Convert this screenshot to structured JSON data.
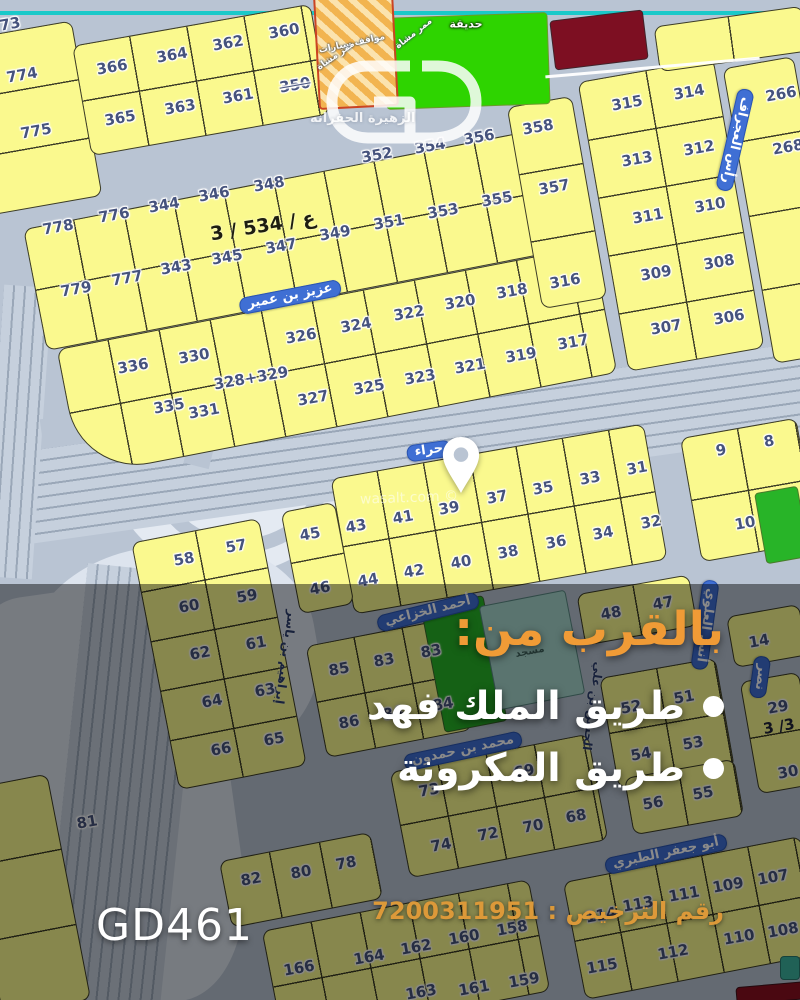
{
  "colors": {
    "plot_yellow": "#FAF98E",
    "plot_line": "#3C3C26",
    "road": "#B9C4D3",
    "road_light": "#C6D0DD",
    "road_dark": "#9AA7B8",
    "cyan_line": "#1AC9C9",
    "badge_blue": "#3F6FD4",
    "park_green": "#2ED400",
    "park_green2": "#28B428",
    "teal_plot": "#A7D6CD",
    "teal_icon": "#3BB3A0",
    "maroon": "#7D0F22",
    "red_bar": "#8A1020",
    "hatch_orange": "#F2B450",
    "hatch_light": "#FBE3AE",
    "hatch_border": "#CC4422",
    "number_blue": "#46537D",
    "promo_orange": "#F09B36",
    "license_orange": "#DC9939"
  },
  "overlay": {
    "heading": "بالقرب من:",
    "items": [
      "طريق الملك فهد",
      "طريق المكرونة"
    ],
    "code": "GD461",
    "license_text": "رقم الترخيص : 7200311951"
  },
  "watermarks": {
    "logo": "GD",
    "district": "الزهيرة الحفرانه",
    "site": "wasalt.com ©"
  },
  "map": {
    "areas": [
      {
        "x": 112,
        "y": 366,
        "w": 236,
        "h": 208,
        "bg": "#E4EAF2",
        "rad": "50%",
        "r": 0
      },
      {
        "x": 150,
        "y": 393,
        "w": 152,
        "h": 132,
        "rad": "50%",
        "r": 0,
        "ring": "#B9C4D3"
      },
      {
        "x": 26,
        "y": 545,
        "w": 292,
        "h": 232,
        "bg": "#DDE4EE",
        "rad": "45%",
        "r": -10
      },
      {
        "x": -30,
        "y": 588,
        "w": 262,
        "h": 422,
        "bg": "#DCE3ED",
        "rad": "30%",
        "r": -8
      }
    ],
    "roads": [
      {
        "x": -50,
        "y": 398,
        "w": 920,
        "h": 92,
        "rot": -8,
        "style": "h"
      },
      {
        "x": -6,
        "y": 286,
        "w": 48,
        "h": 292,
        "rot": 4,
        "style": "v"
      },
      {
        "x": 64,
        "y": 568,
        "w": 118,
        "h": 452,
        "rot": 6,
        "style": "v"
      },
      {
        "x": 40,
        "y": 398,
        "w": 305,
        "h": 26,
        "rot": -8,
        "style": "flat"
      },
      {
        "x": 200,
        "y": 328,
        "w": 26,
        "h": 140,
        "rot": 14,
        "style": "flat"
      }
    ],
    "blocks": [
      {
        "x": -38,
        "y": 30,
        "w": 126,
        "h": 178,
        "rot": -10,
        "cell": 999,
        "rows": 3
      },
      {
        "x": 80,
        "y": 24,
        "w": 242,
        "h": 112,
        "rot": -10,
        "cell": 58,
        "rows": 2
      },
      {
        "x": 30,
        "y": 176,
        "w": 546,
        "h": 124,
        "rot": -11,
        "cell": 51,
        "rows": 2
      },
      {
        "x": 64,
        "y": 296,
        "w": 546,
        "h": 130,
        "rot": -11,
        "cell": 52,
        "rows": 2,
        "br": "10px 10px 10px 70px"
      },
      {
        "x": 524,
        "y": 100,
        "w": 66,
        "h": 205,
        "rot": -10,
        "cell": 999,
        "rows": 3
      },
      {
        "x": 602,
        "y": 68,
        "w": 138,
        "h": 294,
        "rot": -10,
        "cell": 69,
        "rows": 5
      },
      {
        "x": 748,
        "y": 60,
        "w": 72,
        "h": 300,
        "rot": -10,
        "cell": 999,
        "rows": 4
      },
      {
        "x": 656,
        "y": 16,
        "w": 150,
        "h": 46,
        "rot": -8,
        "cell": 75,
        "rows": 1
      },
      {
        "x": 340,
        "y": 450,
        "w": 318,
        "h": 138,
        "rot": -10,
        "cell": 47,
        "rows": 2
      },
      {
        "x": 690,
        "y": 427,
        "w": 118,
        "h": 126,
        "rot": -10,
        "cell": 58,
        "rows": 2
      },
      {
        "x": 154,
        "y": 528,
        "w": 130,
        "h": 252,
        "rot": -11,
        "cell": 65,
        "rows": 5
      },
      {
        "x": 290,
        "y": 506,
        "w": 55,
        "h": 104,
        "rot": -11,
        "cell": 999,
        "rows": 2
      },
      {
        "x": 580,
        "y": 584,
        "w": 114,
        "h": 52,
        "rot": -10,
        "cell": 57,
        "rows": 1
      },
      {
        "x": 730,
        "y": 610,
        "w": 74,
        "h": 52,
        "rot": -10,
        "cell": 999,
        "rows": 1
      },
      {
        "x": 315,
        "y": 631,
        "w": 148,
        "h": 114,
        "rot": -11,
        "cell": 49,
        "rows": 2
      },
      {
        "x": 608,
        "y": 667,
        "w": 118,
        "h": 112,
        "rot": -10,
        "cell": 58,
        "rows": 2
      },
      {
        "x": 749,
        "y": 676,
        "w": 60,
        "h": 114,
        "rot": -10,
        "cell": 999,
        "rows": 2
      },
      {
        "x": 628,
        "y": 768,
        "w": 112,
        "h": 58,
        "rot": -10,
        "cell": 55,
        "rows": 1
      },
      {
        "x": 398,
        "y": 752,
        "w": 202,
        "h": 108,
        "rot": -11,
        "cell": 49,
        "rows": 2
      },
      {
        "x": 224,
        "y": 846,
        "w": 154,
        "h": 68,
        "rot": -11,
        "cell": 51,
        "rows": 1
      },
      {
        "x": 270,
        "y": 904,
        "w": 272,
        "h": 114,
        "rot": -11,
        "cell": 50,
        "rows": 2
      },
      {
        "x": 572,
        "y": 858,
        "w": 242,
        "h": 120,
        "rot": -11,
        "cell": 47,
        "rows": 2
      },
      {
        "x": -20,
        "y": 780,
        "w": 90,
        "h": 230,
        "rot": -11,
        "cell": 999,
        "rows": 3
      }
    ],
    "specials": [
      {
        "type": "rect",
        "x": 385,
        "y": 15,
        "w": 162,
        "h": 90,
        "rot": -2,
        "color": "park_green",
        "border": "#6a9a2a"
      },
      {
        "type": "hatch",
        "x": 316,
        "y": -6,
        "w": 76,
        "h": 110,
        "rot": -3
      },
      {
        "type": "rect",
        "x": 552,
        "y": 15,
        "w": 92,
        "h": 48,
        "rot": -7,
        "color": "maroon",
        "border": "#40232a"
      },
      {
        "type": "rect",
        "x": 760,
        "y": 489,
        "w": 42,
        "h": 70,
        "rot": -10,
        "color": "park_green2",
        "border": "#4a7a2a"
      },
      {
        "type": "rect",
        "x": 432,
        "y": 600,
        "w": 62,
        "h": 126,
        "rot": -11,
        "color": "park_green2",
        "border": "#3a6a2a"
      },
      {
        "type": "rect",
        "x": 488,
        "y": 597,
        "w": 86,
        "h": 104,
        "rot": -11,
        "color": "teal_plot",
        "border": "#5a8a84"
      },
      {
        "type": "rect",
        "x": 736,
        "y": 984,
        "w": 72,
        "h": 16,
        "rot": -5,
        "color": "red_bar",
        "border": "#40121a"
      },
      {
        "type": "rect",
        "x": 780,
        "y": 956,
        "w": 18,
        "h": 22,
        "rot": 0,
        "color": "teal_icon",
        "border": "#2a7a70"
      }
    ],
    "labels": [
      {
        "t": "عزيز بن عمير",
        "x": 290,
        "y": 297,
        "r": -11,
        "cls": "badge",
        "nm": "street-label-aziz-bin-umair"
      },
      {
        "t": "حراء",
        "x": 429,
        "y": 451,
        "r": -8,
        "cls": "badge",
        "nm": "street-label-hira"
      },
      {
        "t": "رأس العجراف",
        "x": 735,
        "y": 140,
        "r": 103,
        "cls": "badge",
        "nm": "street-label-ras-alajraf"
      },
      {
        "t": "أنس العلوي",
        "x": 705,
        "y": 625,
        "r": 98,
        "cls": "badge",
        "nm": "street-label-anas-alalawi"
      },
      {
        "t": "أحمد الخزاعي",
        "x": 428,
        "y": 612,
        "r": -14,
        "cls": "badge",
        "nm": "street-label-ahmad-alkhuzai"
      },
      {
        "t": "محمد بن حمدون",
        "x": 463,
        "y": 751,
        "r": -12,
        "cls": "badge",
        "nm": "street-label-mohammed-bin-hamdun"
      },
      {
        "t": "أبو جعفر الطبري",
        "x": 666,
        "y": 854,
        "r": -12,
        "cls": "badge",
        "nm": "street-label-abu-jafar-altabari"
      },
      {
        "t": "نصر",
        "x": 760,
        "y": 677,
        "r": 98,
        "cls": "badge",
        "nm": "street-label-nasr"
      },
      {
        "t": "الحسن بن علي",
        "x": 592,
        "y": 706,
        "r": 98,
        "cls": "navy",
        "nm": "street-label-alhasan-bin-ali"
      },
      {
        "t": "إبراهيم بن ياسر",
        "x": 285,
        "y": 657,
        "r": 98,
        "cls": "navy",
        "nm": "street-label-ibrahim-bin-yasir"
      },
      {
        "t": "حديقة",
        "x": 466,
        "y": 25,
        "r": 0,
        "cls": "white-sm",
        "nm": "park-label"
      },
      {
        "t": "ممر مشاة",
        "x": 414,
        "y": 34,
        "r": -38,
        "cls": "white-xs",
        "nm": "walkway-label"
      },
      {
        "t": "مواقف سيارات",
        "x": 352,
        "y": 44,
        "r": -12,
        "cls": "white-xs",
        "nm": "parking-label"
      },
      {
        "t": "ممر مشاة",
        "x": 336,
        "y": 56,
        "r": -35,
        "cls": "white-xs",
        "nm": "walkway-label"
      },
      {
        "t": "مسجد",
        "x": 530,
        "y": 652,
        "r": -11,
        "cls": "dark-xs",
        "nm": "mosque-label"
      },
      {
        "t": "3 / 534 / ع",
        "x": 263,
        "y": 227,
        "r": -9,
        "cls": "dark-lg",
        "dir": "ltr",
        "nm": "block-plan-label"
      },
      {
        "t": "3 /3",
        "x": 779,
        "y": 727,
        "r": -10,
        "cls": "dark-md",
        "dir": "ltr",
        "nm": "block-plan-label"
      }
    ],
    "plots": [
      {
        "n": "73",
        "x": 10,
        "y": 24
      },
      {
        "n": "774",
        "x": 22,
        "y": 75
      },
      {
        "n": "775",
        "x": 36,
        "y": 131
      },
      {
        "n": "366",
        "x": 112,
        "y": 67
      },
      {
        "n": "364",
        "x": 172,
        "y": 55
      },
      {
        "n": "362",
        "x": 228,
        "y": 43
      },
      {
        "n": "360",
        "x": 284,
        "y": 31
      },
      {
        "n": "365",
        "x": 120,
        "y": 118
      },
      {
        "n": "363",
        "x": 180,
        "y": 107
      },
      {
        "n": "361",
        "x": 238,
        "y": 96
      },
      {
        "n": "350",
        "x": 295,
        "y": 85,
        "s": 1
      },
      {
        "n": "778",
        "x": 58,
        "y": 227
      },
      {
        "n": "776",
        "x": 114,
        "y": 215
      },
      {
        "n": "344",
        "x": 164,
        "y": 205
      },
      {
        "n": "346",
        "x": 214,
        "y": 194
      },
      {
        "n": "348",
        "x": 269,
        "y": 184
      },
      {
        "n": "352",
        "x": 377,
        "y": 155
      },
      {
        "n": "354",
        "x": 430,
        "y": 146
      },
      {
        "n": "356",
        "x": 479,
        "y": 137
      },
      {
        "n": "358",
        "x": 538,
        "y": 127
      },
      {
        "n": "779",
        "x": 76,
        "y": 289
      },
      {
        "n": "777",
        "x": 127,
        "y": 278
      },
      {
        "n": "343",
        "x": 176,
        "y": 267
      },
      {
        "n": "345",
        "x": 227,
        "y": 257
      },
      {
        "n": "347",
        "x": 281,
        "y": 246
      },
      {
        "n": "349",
        "x": 335,
        "y": 233
      },
      {
        "n": "351",
        "x": 389,
        "y": 222
      },
      {
        "n": "353",
        "x": 443,
        "y": 211
      },
      {
        "n": "355",
        "x": 497,
        "y": 199
      },
      {
        "n": "357",
        "x": 554,
        "y": 187
      },
      {
        "n": "336",
        "x": 133,
        "y": 366
      },
      {
        "n": "330",
        "x": 194,
        "y": 356
      },
      {
        "n": "326",
        "x": 301,
        "y": 336
      },
      {
        "n": "324",
        "x": 356,
        "y": 325
      },
      {
        "n": "322",
        "x": 409,
        "y": 313
      },
      {
        "n": "320",
        "x": 460,
        "y": 302
      },
      {
        "n": "318",
        "x": 512,
        "y": 291
      },
      {
        "n": "316",
        "x": 565,
        "y": 281
      },
      {
        "n": "335",
        "x": 169,
        "y": 406
      },
      {
        "n": "331",
        "x": 204,
        "y": 411
      },
      {
        "n": "328+329",
        "x": 251,
        "y": 378
      },
      {
        "n": "327",
        "x": 313,
        "y": 398
      },
      {
        "n": "325",
        "x": 369,
        "y": 387
      },
      {
        "n": "323",
        "x": 420,
        "y": 377
      },
      {
        "n": "321",
        "x": 470,
        "y": 366
      },
      {
        "n": "319",
        "x": 521,
        "y": 355
      },
      {
        "n": "317",
        "x": 573,
        "y": 342
      },
      {
        "n": "315",
        "x": 627,
        "y": 103
      },
      {
        "n": "314",
        "x": 689,
        "y": 92
      },
      {
        "n": "266",
        "x": 781,
        "y": 94
      },
      {
        "n": "313",
        "x": 637,
        "y": 159
      },
      {
        "n": "312",
        "x": 699,
        "y": 148
      },
      {
        "n": "268",
        "x": 788,
        "y": 147
      },
      {
        "n": "311",
        "x": 648,
        "y": 216
      },
      {
        "n": "310",
        "x": 710,
        "y": 205
      },
      {
        "n": "309",
        "x": 656,
        "y": 273
      },
      {
        "n": "308",
        "x": 719,
        "y": 262
      },
      {
        "n": "307",
        "x": 666,
        "y": 327
      },
      {
        "n": "306",
        "x": 729,
        "y": 317
      },
      {
        "n": "8",
        "x": 769,
        "y": 441
      },
      {
        "n": "9",
        "x": 721,
        "y": 450
      },
      {
        "n": "10",
        "x": 745,
        "y": 523
      },
      {
        "n": "31",
        "x": 637,
        "y": 468
      },
      {
        "n": "33",
        "x": 590,
        "y": 478
      },
      {
        "n": "35",
        "x": 543,
        "y": 488
      },
      {
        "n": "37",
        "x": 497,
        "y": 497
      },
      {
        "n": "39",
        "x": 449,
        "y": 508
      },
      {
        "n": "41",
        "x": 403,
        "y": 517
      },
      {
        "n": "43",
        "x": 356,
        "y": 526
      },
      {
        "n": "32",
        "x": 651,
        "y": 522
      },
      {
        "n": "34",
        "x": 603,
        "y": 533
      },
      {
        "n": "36",
        "x": 556,
        "y": 542
      },
      {
        "n": "38",
        "x": 508,
        "y": 552
      },
      {
        "n": "40",
        "x": 461,
        "y": 562
      },
      {
        "n": "42",
        "x": 414,
        "y": 571
      },
      {
        "n": "44",
        "x": 368,
        "y": 580
      },
      {
        "n": "45",
        "x": 310,
        "y": 534
      },
      {
        "n": "46",
        "x": 320,
        "y": 588
      },
      {
        "n": "58",
        "x": 184,
        "y": 559
      },
      {
        "n": "57",
        "x": 236,
        "y": 546
      },
      {
        "n": "59",
        "x": 247,
        "y": 596
      },
      {
        "n": "60",
        "x": 189,
        "y": 606
      },
      {
        "n": "61",
        "x": 256,
        "y": 643
      },
      {
        "n": "62",
        "x": 200,
        "y": 653
      },
      {
        "n": "63",
        "x": 265,
        "y": 690
      },
      {
        "n": "64",
        "x": 212,
        "y": 701
      },
      {
        "n": "65",
        "x": 274,
        "y": 739
      },
      {
        "n": "66",
        "x": 221,
        "y": 749
      },
      {
        "n": "47",
        "x": 663,
        "y": 603
      },
      {
        "n": "48",
        "x": 611,
        "y": 613
      },
      {
        "n": "14",
        "x": 759,
        "y": 641
      },
      {
        "n": "83",
        "x": 384,
        "y": 660
      },
      {
        "n": "83",
        "x": 431,
        "y": 651
      },
      {
        "n": "85",
        "x": 339,
        "y": 669
      },
      {
        "n": "84",
        "x": 393,
        "y": 713
      },
      {
        "n": "84",
        "x": 443,
        "y": 704
      },
      {
        "n": "86",
        "x": 349,
        "y": 722
      },
      {
        "n": "51",
        "x": 684,
        "y": 697
      },
      {
        "n": "52",
        "x": 631,
        "y": 707
      },
      {
        "n": "29",
        "x": 778,
        "y": 707
      },
      {
        "n": "53",
        "x": 693,
        "y": 743
      },
      {
        "n": "54",
        "x": 641,
        "y": 754
      },
      {
        "n": "30",
        "x": 788,
        "y": 772
      },
      {
        "n": "55",
        "x": 703,
        "y": 793
      },
      {
        "n": "56",
        "x": 653,
        "y": 803
      },
      {
        "n": "69",
        "x": 524,
        "y": 771
      },
      {
        "n": "73",
        "x": 429,
        "y": 790
      },
      {
        "n": "68",
        "x": 576,
        "y": 816
      },
      {
        "n": "70",
        "x": 533,
        "y": 826
      },
      {
        "n": "72",
        "x": 488,
        "y": 834
      },
      {
        "n": "74",
        "x": 441,
        "y": 845
      },
      {
        "n": "81",
        "x": 87,
        "y": 822
      },
      {
        "n": "78",
        "x": 346,
        "y": 863
      },
      {
        "n": "80",
        "x": 301,
        "y": 872
      },
      {
        "n": "82",
        "x": 251,
        "y": 879
      },
      {
        "n": "107",
        "x": 773,
        "y": 877
      },
      {
        "n": "109",
        "x": 728,
        "y": 885
      },
      {
        "n": "111",
        "x": 684,
        "y": 894
      },
      {
        "n": "113",
        "x": 638,
        "y": 904
      },
      {
        "n": "114",
        "x": 601,
        "y": 915
      },
      {
        "n": "112",
        "x": 673,
        "y": 952
      },
      {
        "n": "110",
        "x": 739,
        "y": 937
      },
      {
        "n": "108",
        "x": 783,
        "y": 930
      },
      {
        "n": "115",
        "x": 602,
        "y": 966
      },
      {
        "n": "158",
        "x": 512,
        "y": 928
      },
      {
        "n": "160",
        "x": 464,
        "y": 937
      },
      {
        "n": "162",
        "x": 416,
        "y": 947
      },
      {
        "n": "164",
        "x": 369,
        "y": 957
      },
      {
        "n": "166",
        "x": 299,
        "y": 968
      },
      {
        "n": "159",
        "x": 524,
        "y": 980
      },
      {
        "n": "161",
        "x": 474,
        "y": 988
      },
      {
        "n": "163",
        "x": 421,
        "y": 992
      }
    ]
  }
}
